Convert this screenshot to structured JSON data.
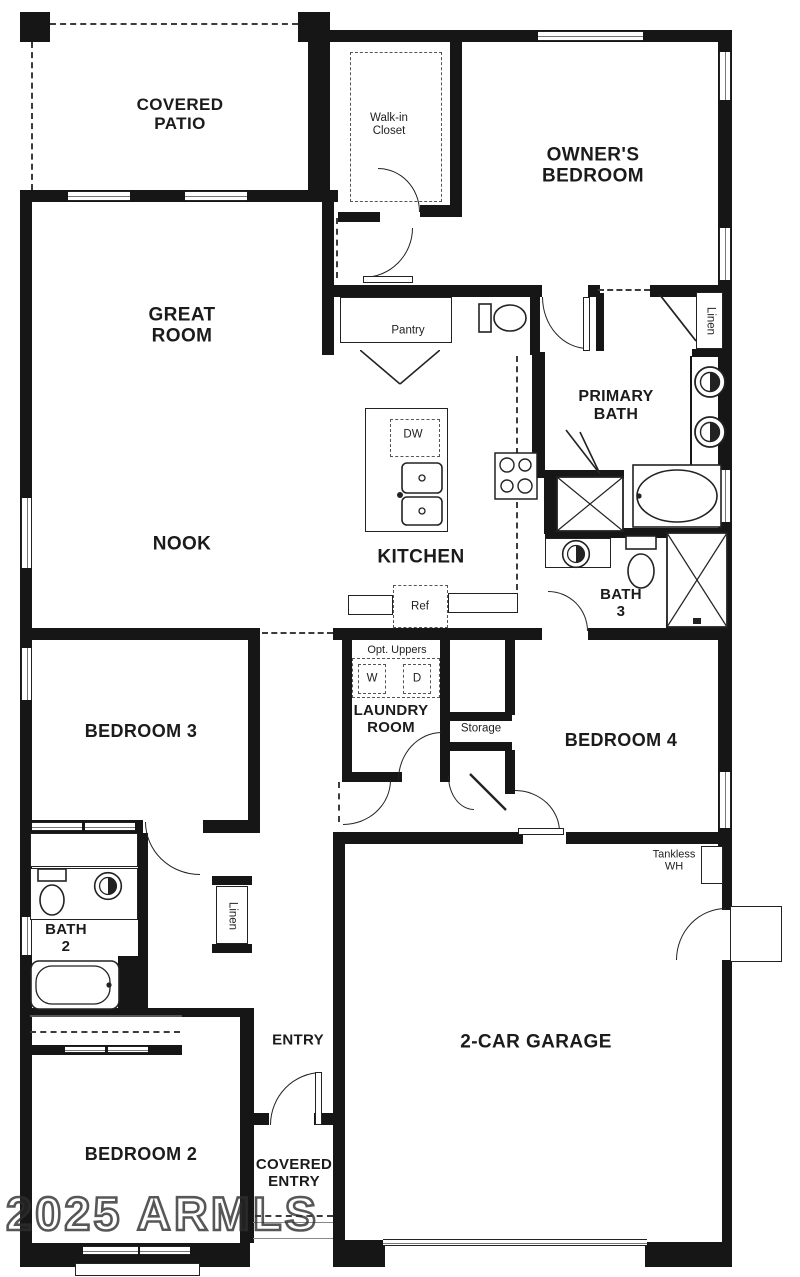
{
  "watermark": "2025 ARMLS",
  "rooms": {
    "covered_patio": "COVERED\nPATIO",
    "walk_in_closet": "Walk-in\nCloset",
    "owners_bedroom": "OWNER'S\nBEDROOM",
    "great_room": "GREAT\nROOM",
    "nook": "NOOK",
    "kitchen": "KITCHEN",
    "pantry": "Pantry",
    "primary_bath": "PRIMARY\nBATH",
    "bath_3": "BATH\n3",
    "laundry_room": "LAUNDRY\nROOM",
    "bedroom_4": "BEDROOM 4",
    "bedroom_3": "BEDROOM 3",
    "bath_2": "BATH\n2",
    "bedroom_2": "BEDROOM 2",
    "entry": "ENTRY",
    "covered_entry": "COVERED\nENTRY",
    "garage": "2-CAR GARAGE"
  },
  "fixtures": {
    "dw": "DW",
    "ref": "Ref",
    "opt_uppers": "Opt. Uppers",
    "washer": "W",
    "dryer": "D",
    "storage": "Storage",
    "linen_primary": "Linen",
    "linen_hall": "Linen",
    "tankless_wh": "Tankless\nWH"
  },
  "colors": {
    "wall": "#161616",
    "background": "#ffffff",
    "watermark": "#2d2d2d"
  }
}
